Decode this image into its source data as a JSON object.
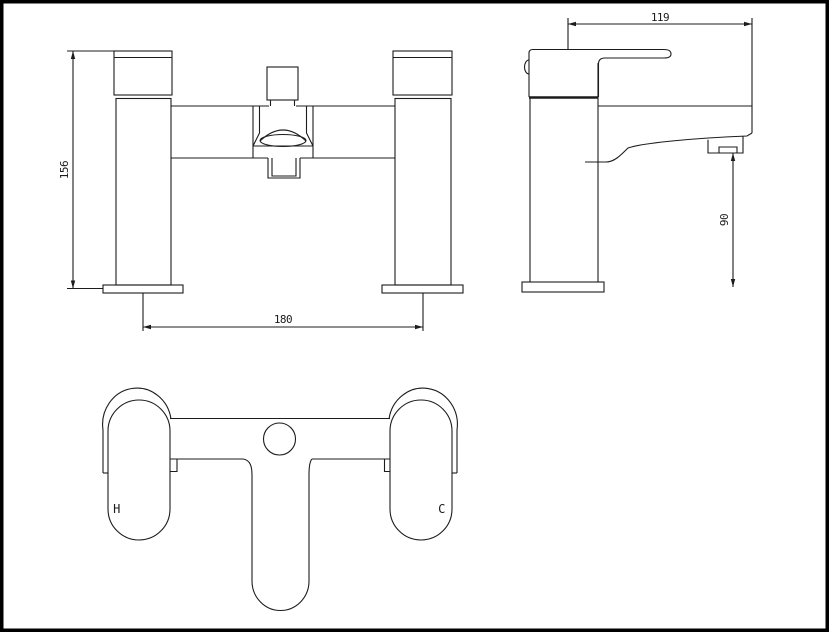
{
  "colors": {
    "line": "#1c1c1c",
    "background": "#ffffff",
    "frame": "#000000"
  },
  "labels": {
    "front_height": "156",
    "pillar_centers": "180",
    "side_reach": "119",
    "spout_height": "90",
    "hot": "H",
    "cold": "C"
  }
}
